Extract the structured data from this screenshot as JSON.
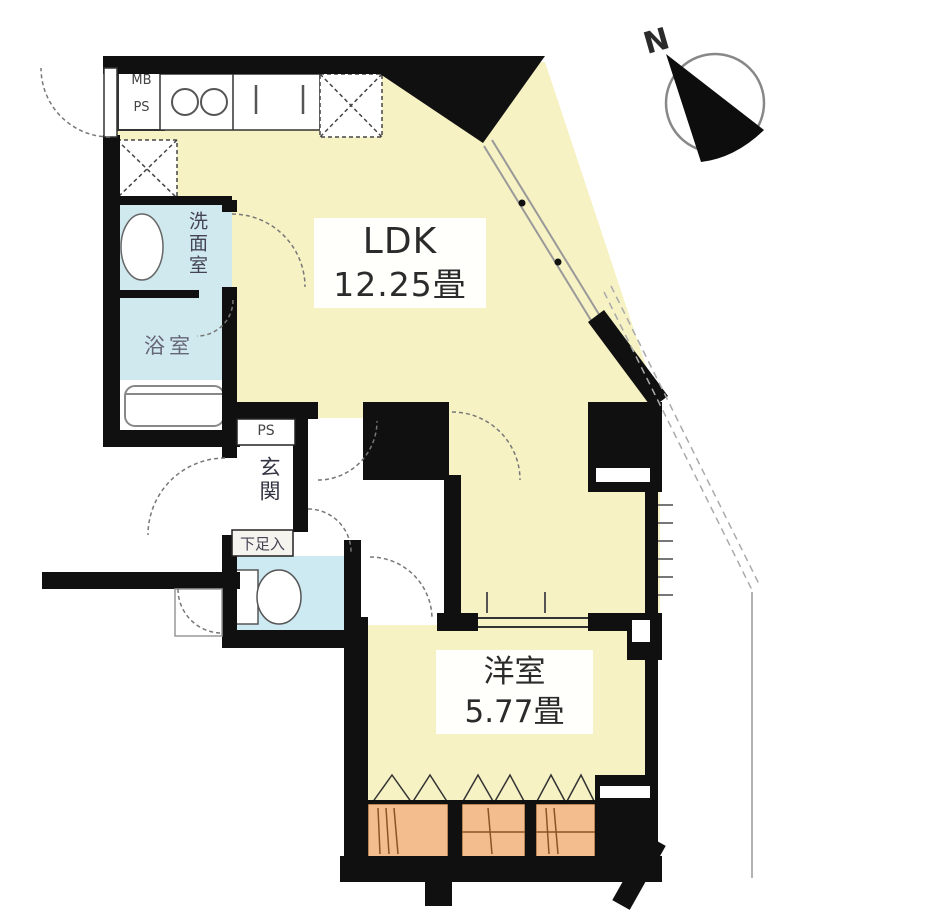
{
  "floorplan": {
    "rooms": {
      "ldk": {
        "name": "LDK",
        "size": "12.25畳"
      },
      "bedroom": {
        "name": "洋室",
        "size": "5.77畳"
      },
      "washroom": {
        "name": "洗面室"
      },
      "bathroom": {
        "name": "浴室"
      },
      "entrance": {
        "name": "玄関"
      },
      "shoe_cabinet": {
        "name": "下足入"
      }
    },
    "labels": {
      "meter_box": "MB",
      "pipe_shaft_top": "PS",
      "pipe_shaft_entrance": "PS",
      "compass_north": "N"
    },
    "colors": {
      "room_yellow": "#f6f2c4",
      "wet_area_blue": "#cfe9ee",
      "closet_orange": "#f3bd8d",
      "wall_black": "#101010",
      "door_arc_gray": "#777777"
    }
  }
}
